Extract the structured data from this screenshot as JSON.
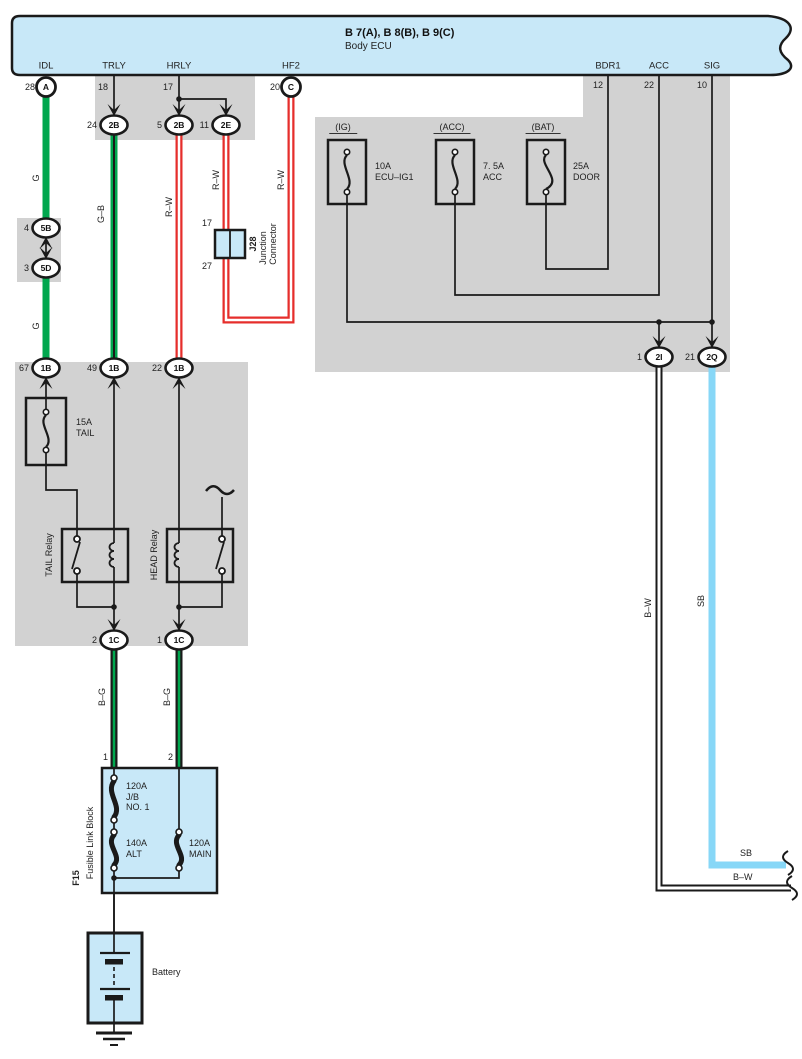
{
  "ecu": {
    "title": "B 7(A), B 8(B), B 9(C)",
    "subtitle": "Body ECU",
    "pins": [
      {
        "name": "IDL",
        "num": "28",
        "term": "A"
      },
      {
        "name": "TRLY",
        "num": "18"
      },
      {
        "name": "HRLY",
        "num": "17"
      },
      {
        "name": "HF2",
        "num": "20",
        "term": "C"
      },
      {
        "name": "BDR1",
        "num": "12"
      },
      {
        "name": "ACC",
        "num": "22"
      },
      {
        "name": "SIG",
        "num": "10"
      }
    ]
  },
  "connectors": {
    "c2b_24": {
      "num": "24",
      "id": "2B"
    },
    "c2b_5": {
      "num": "5",
      "id": "2B"
    },
    "c2e_11": {
      "num": "11",
      "id": "2E"
    },
    "c5b": {
      "num": "4",
      "id": "5B"
    },
    "c5d": {
      "num": "3",
      "id": "5D"
    },
    "c1b_67": {
      "num": "67",
      "id": "1B"
    },
    "c1b_49": {
      "num": "49",
      "id": "1B"
    },
    "c1b_22": {
      "num": "22",
      "id": "1B"
    },
    "c1c_2": {
      "num": "2",
      "id": "1C"
    },
    "c1c_1": {
      "num": "1",
      "id": "1C"
    },
    "c2i": {
      "num": "1",
      "id": "2I"
    },
    "c2q": {
      "num": "21",
      "id": "2Q"
    }
  },
  "junction_connector": {
    "id": "J28",
    "name_line1": "Junction",
    "name_line2": "Connector",
    "pin_top": "17",
    "pin_bottom": "27"
  },
  "fuses": {
    "ig": {
      "tag": "(IG)",
      "rating": "10A",
      "name": "ECU–IG1"
    },
    "acc": {
      "tag": "(ACC)",
      "rating": "7. 5A",
      "name": "ACC"
    },
    "bat": {
      "tag": "(BAT)",
      "rating": "25A",
      "name": "DOOR"
    },
    "tail": {
      "rating": "15A",
      "name": "TAIL"
    }
  },
  "relays": {
    "tail": "TAIL Relay",
    "head": "HEAD Relay"
  },
  "fusible_link_block": {
    "id": "F15",
    "name": "Fusible Link Block",
    "pin_left": "1",
    "pin_right": "2",
    "link1": {
      "rating": "120A",
      "name1": "J/B",
      "name2": "NO. 1"
    },
    "link2": {
      "rating": "140A",
      "name": "ALT"
    },
    "link3": {
      "rating": "120A",
      "name": "MAIN"
    }
  },
  "battery": {
    "label": "Battery"
  },
  "wires": {
    "g1": "G",
    "g2": "G",
    "gb": "G–B",
    "rw1": "R–W",
    "rw2": "R–W",
    "rw3": "R–W",
    "bg1": "B–G",
    "bg2": "B–G",
    "bw_vertical": "B–W",
    "sb_vertical": "SB",
    "sb_horizontal": "SB",
    "bw_horizontal": "B–W"
  },
  "colors": {
    "panel_blue": "#c8e8f8",
    "shade_gray": "#d2d2d2",
    "wire_green": "#00a74e",
    "wire_red": "#e62e2b",
    "wire_sky": "#87d7f7",
    "wire_black": "#1a1a1a"
  }
}
